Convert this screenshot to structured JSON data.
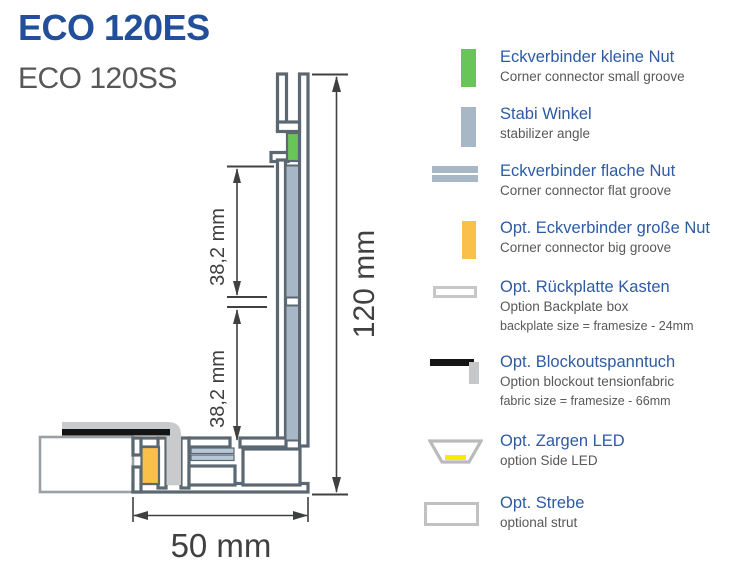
{
  "title": {
    "primary": "ECO 120ES",
    "secondary": "ECO 120SS"
  },
  "drawing": {
    "dim_total_height": "120 mm",
    "dim_upper_segment": "38,2 mm",
    "dim_lower_segment": "38,2 mm",
    "dim_base_width": "50 mm"
  },
  "legend": {
    "items": [
      {
        "icon": "corner-connector-small-groove-icon",
        "title": "Eckverbinder kleine Nut",
        "subtitle": "Corner connector small groove"
      },
      {
        "icon": "stabilizer-angle-icon",
        "title": "Stabi Winkel",
        "subtitle": "stabilizer angle"
      },
      {
        "icon": "corner-connector-flat-groove-icon",
        "title": "Eckverbinder flache Nut",
        "subtitle": "Corner connector flat groove"
      },
      {
        "icon": "corner-connector-big-groove-icon",
        "title": "Opt. Eckverbinder große Nut",
        "subtitle": "Corner connector big groove"
      },
      {
        "icon": "backplate-box-icon",
        "title": "Opt. Rückplatte Kasten",
        "subtitle": "Option Backplate box",
        "note": "backplate size = framesize - 24mm"
      },
      {
        "icon": "blockout-fabric-icon",
        "title": "Opt. Blockoutspanntuch",
        "subtitle": "Option blockout tensionfabric",
        "note": "fabric size = framesize - 66mm"
      },
      {
        "icon": "side-led-icon",
        "title": "Opt. Zargen LED",
        "subtitle": "option Side LED"
      },
      {
        "icon": "strut-icon",
        "title": "Opt. Strebe",
        "subtitle": "optional strut"
      }
    ]
  },
  "colors": {
    "brand_blue": "#234f9a",
    "legend_blue": "#2d5ba4",
    "text_gray": "#58585a",
    "profile_outline": "#5b6872",
    "stabilizer_gray": "#a8b7c5",
    "flat_groove_gray": "#b9c8d6",
    "connector_green": "#6ac558",
    "connector_orange": "#f9c04a",
    "led_yellow": "#f5ec00",
    "fabric_gray": "#c9cacb",
    "blockout_black": "#141414"
  }
}
